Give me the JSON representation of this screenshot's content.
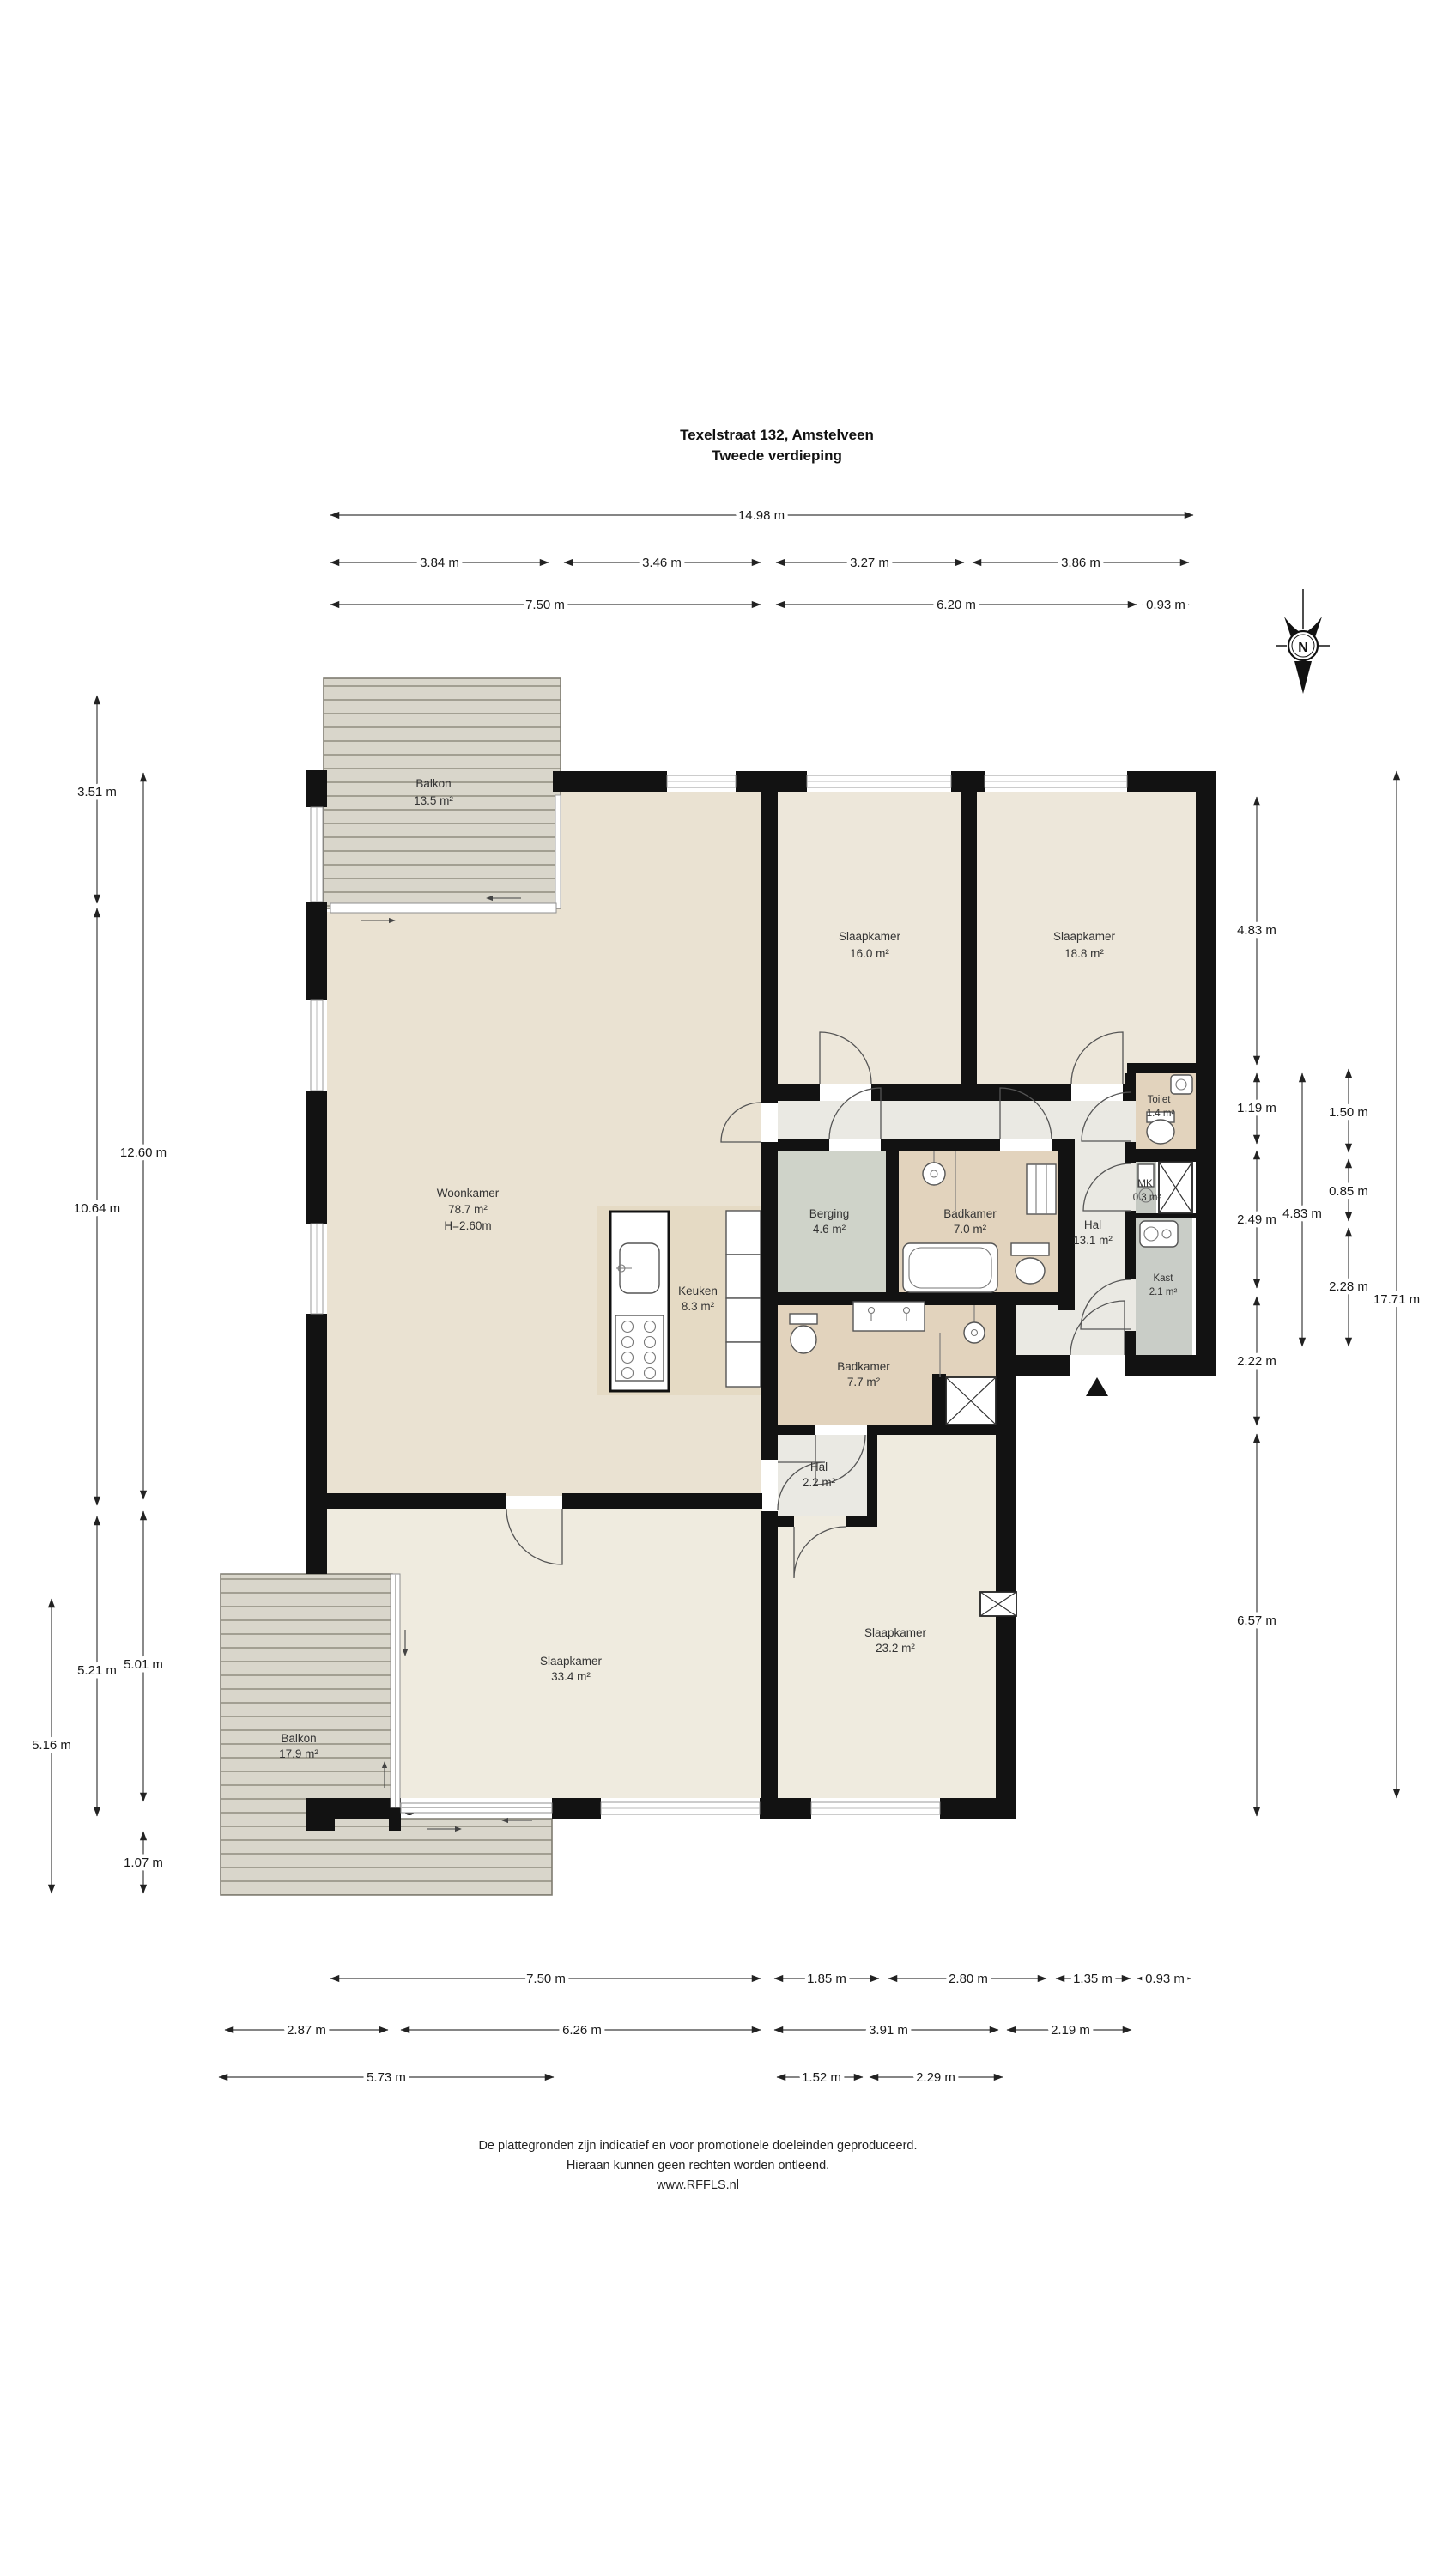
{
  "title": {
    "line1": "Texelstraat 132, Amstelveen",
    "line2": "Tweede verdieping"
  },
  "compass": {
    "n": "N"
  },
  "rooms": {
    "balkon_top": {
      "name": "Balkon",
      "area": "13.5 m²"
    },
    "slaapkamer_16": {
      "name": "Slaapkamer",
      "area": "16.0 m²"
    },
    "slaapkamer_18": {
      "name": "Slaapkamer",
      "area": "18.8 m²"
    },
    "toilet": {
      "name": "Toilet",
      "area": "1.4 m²"
    },
    "woonkamer": {
      "name": "Woonkamer",
      "area": "78.7 m²",
      "height": "H=2.60m"
    },
    "berging": {
      "name": "Berging",
      "area": "4.6 m²"
    },
    "badkamer_70": {
      "name": "Badkamer",
      "area": "7.0 m²"
    },
    "hal_131": {
      "name": "Hal",
      "area": "13.1 m²"
    },
    "mk": {
      "name": "MK",
      "area": "0.3 m²"
    },
    "kast": {
      "name": "Kast",
      "area": "2.1 m²"
    },
    "keuken": {
      "name": "Keuken",
      "area": "8.3 m²"
    },
    "badkamer_77": {
      "name": "Badkamer",
      "area": "7.7 m²"
    },
    "hal_22": {
      "name": "Hal",
      "area": "2.2 m²"
    },
    "slaapkamer_334": {
      "name": "Slaapkamer",
      "area": "33.4 m²"
    },
    "slaapkamer_232": {
      "name": "Slaapkamer",
      "area": "23.2 m²"
    },
    "balkon_bottom": {
      "name": "Balkon",
      "area": "17.9 m²"
    }
  },
  "dims": {
    "top1": "14.98 m",
    "top2": [
      "3.84 m",
      "3.46 m",
      "3.27 m",
      "3.86 m"
    ],
    "top3": [
      "7.50 m",
      "6.20 m",
      "0.93 m"
    ],
    "left": [
      "3.51 m",
      "12.60 m",
      "10.64 m",
      "5.21 m",
      "5.01 m",
      "5.16 m",
      "1.07 m"
    ],
    "right": [
      "4.83 m",
      "1.19 m",
      "2.49 m",
      "2.22 m",
      "6.57 m",
      "4.83 m",
      "1.50 m",
      "0.85 m",
      "2.28 m",
      "17.71 m"
    ],
    "bottom1": [
      "7.50 m",
      "1.85 m",
      "2.80 m",
      "1.35 m",
      "0.93 m"
    ],
    "bottom2": [
      "2.87 m",
      "6.26 m",
      "3.91 m",
      "2.19 m"
    ],
    "bottom3": [
      "5.73 m",
      "1.52 m",
      "2.29 m"
    ]
  },
  "footer": [
    "De plattegronden zijn indicatief en voor promotionele doeleinden geproduceerd.",
    "Hieraan kunnen geen rechten worden ontleend.",
    "www.RFFLS.nl"
  ],
  "colors": {
    "wall": "#121212",
    "woonkamer": "#EAE2D2",
    "keuken": "#E5DAC4",
    "slaapkamer_top": "#EDE7DA",
    "slaapkamer_bottom": "#EFEBDF",
    "hal": "#EAE9E3",
    "badkamer": "#E2D3BD",
    "berging": "#CFD3C9",
    "kast": "#C9CDC7",
    "balkon": "#D9D6CB"
  }
}
